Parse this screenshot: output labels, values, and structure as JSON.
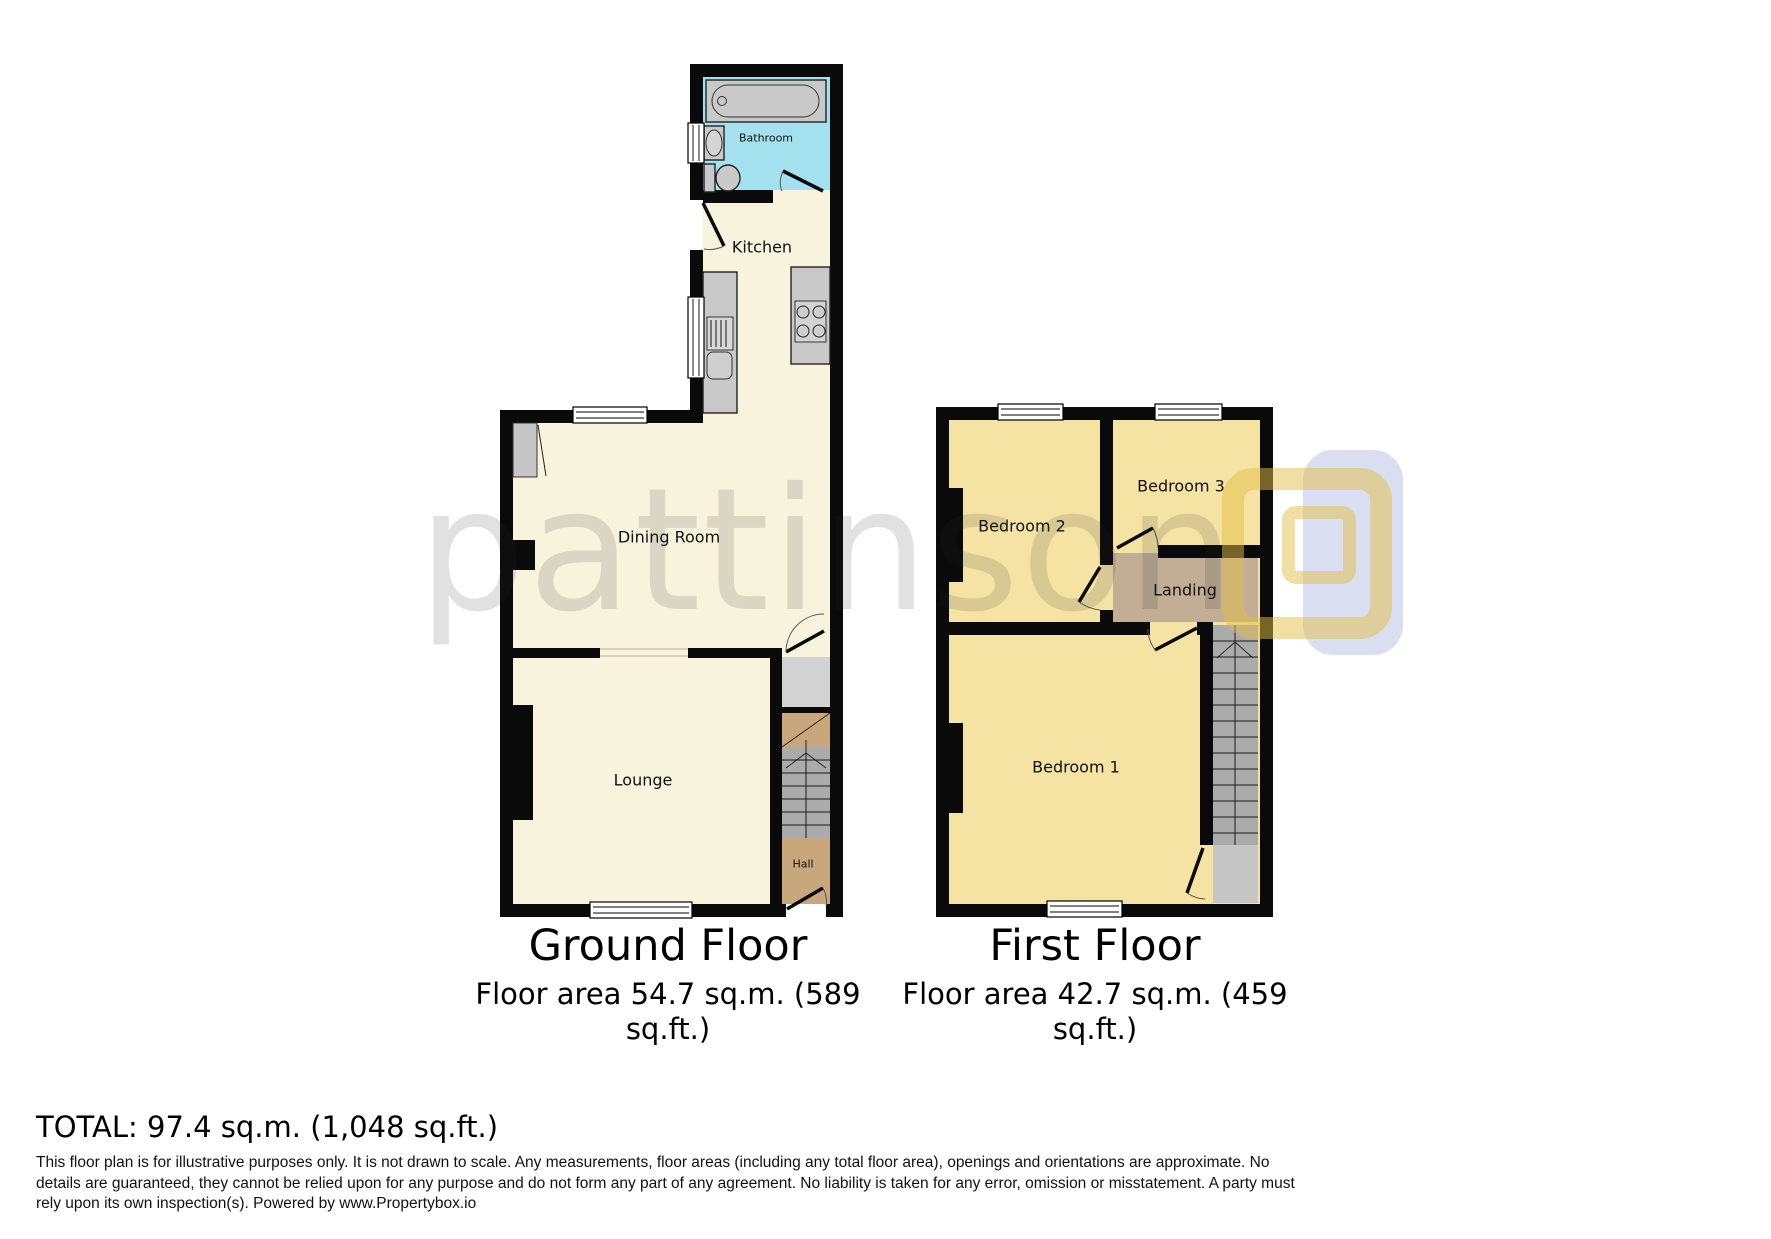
{
  "watermark": {
    "text": "pattinson"
  },
  "ground_floor": {
    "title": "Ground Floor",
    "area_line1": "Floor area 54.7 sq.m. (589",
    "area_line2": "sq.ft.)",
    "rooms": {
      "bathroom": "Bathroom",
      "kitchen": "Kitchen",
      "dining": "Dining Room",
      "lounge": "Lounge",
      "hall": "Hall"
    }
  },
  "first_floor": {
    "title": "First Floor",
    "area_line1": "Floor area 42.7 sq.m. (459",
    "area_line2": "sq.ft.)",
    "rooms": {
      "bedroom1": "Bedroom 1",
      "bedroom2": "Bedroom 2",
      "bedroom3": "Bedroom 3",
      "landing": "Landing"
    }
  },
  "total_line": "TOTAL: 97.4 sq.m. (1,048 sq.ft.)",
  "disclaimer": "This floor plan is for illustrative purposes only. It is not drawn to scale. Any measurements, floor areas (including any total floor area), openings and orientations are approximate. No details are guaranteed, they cannot be relied upon for any purpose and do not form any part of any agreement. No liability is taken for any error, omission or misstatement. A party must rely upon its own inspection(s). Powered by www.Propertybox.io",
  "colors": {
    "walls": "#0a0a0a",
    "ground_room": "#f8f3dc",
    "first_room": "#f4e3a2",
    "bathroom": "#a3e1ef",
    "hall_tan": "#c9a77c",
    "landing_tan": "#c1ae95",
    "stairs_gray": "#ababab",
    "fixture_gray": "#c9c9c9",
    "cupboard_gray": "#c6c6c6",
    "logo_yellow": "#e2be46",
    "logo_blue": "#b9c4e4"
  }
}
